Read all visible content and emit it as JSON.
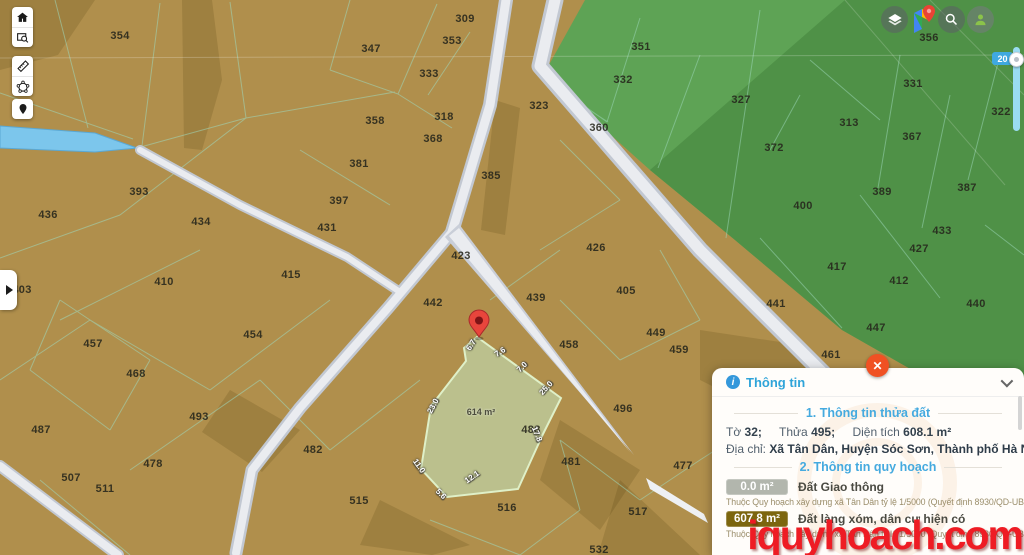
{
  "app": {
    "watermark": "iquyhoach.com"
  },
  "toolbar": {
    "buttons": [
      {
        "icon": "home-icon"
      },
      {
        "icon": "area-zoom-icon"
      },
      {
        "icon": "ruler-icon"
      },
      {
        "icon": "polygon-draw-icon"
      },
      {
        "icon": "location-pin-icon"
      }
    ]
  },
  "topbar": {
    "buttons": [
      {
        "icon": "layers-icon"
      },
      {
        "icon": "google-maps-icon"
      },
      {
        "icon": "search-icon"
      },
      {
        "icon": "user-icon"
      }
    ]
  },
  "zoom_control": {
    "level": "20"
  },
  "map": {
    "colors": {
      "land": "#b08f4c",
      "land_dark_overlay": "rgba(70,52,8,0.16)",
      "green": "#5ea355",
      "green_dark": "#4f9147",
      "road_fill": "#eaecf0",
      "road_casing": "#c2c8d2",
      "water": "#7cc6ec",
      "boundary_line": "#9fd9bd",
      "selected_fill": "#bcc492",
      "selected_stroke": "#dff0c8",
      "pin": "#e8453c"
    },
    "parcels": [
      {
        "n": "354",
        "x": 120,
        "y": 36
      },
      {
        "n": "309",
        "x": 465,
        "y": 19
      },
      {
        "n": "353",
        "x": 452,
        "y": 41
      },
      {
        "n": "347",
        "x": 371,
        "y": 49
      },
      {
        "n": "333",
        "x": 429,
        "y": 74
      },
      {
        "n": "323",
        "x": 539,
        "y": 106
      },
      {
        "n": "351",
        "x": 641,
        "y": 47
      },
      {
        "n": "332",
        "x": 623,
        "y": 80
      },
      {
        "n": "360",
        "x": 599,
        "y": 128
      },
      {
        "n": "327",
        "x": 741,
        "y": 100
      },
      {
        "n": "313",
        "x": 849,
        "y": 123
      },
      {
        "n": "331",
        "x": 913,
        "y": 84
      },
      {
        "n": "356",
        "x": 929,
        "y": 38
      },
      {
        "n": "322",
        "x": 1001,
        "y": 112
      },
      {
        "n": "372",
        "x": 774,
        "y": 148
      },
      {
        "n": "367",
        "x": 912,
        "y": 137
      },
      {
        "n": "389",
        "x": 882,
        "y": 192
      },
      {
        "n": "387",
        "x": 967,
        "y": 188
      },
      {
        "n": "400",
        "x": 803,
        "y": 206
      },
      {
        "n": "433",
        "x": 942,
        "y": 231
      },
      {
        "n": "358",
        "x": 375,
        "y": 121
      },
      {
        "n": "318",
        "x": 444,
        "y": 117
      },
      {
        "n": "368",
        "x": 433,
        "y": 139
      },
      {
        "n": "381",
        "x": 359,
        "y": 164
      },
      {
        "n": "385",
        "x": 491,
        "y": 176
      },
      {
        "n": "397",
        "x": 339,
        "y": 201
      },
      {
        "n": "393",
        "x": 139,
        "y": 192
      },
      {
        "n": "436",
        "x": 48,
        "y": 215
      },
      {
        "n": "434",
        "x": 201,
        "y": 222
      },
      {
        "n": "431",
        "x": 327,
        "y": 228
      },
      {
        "n": "423",
        "x": 461,
        "y": 256
      },
      {
        "n": "426",
        "x": 596,
        "y": 248
      },
      {
        "n": "410",
        "x": 164,
        "y": 282
      },
      {
        "n": "415",
        "x": 291,
        "y": 275
      },
      {
        "n": "403",
        "x": 22,
        "y": 290
      },
      {
        "n": "442",
        "x": 433,
        "y": 303
      },
      {
        "n": "439",
        "x": 536,
        "y": 298
      },
      {
        "n": "405",
        "x": 626,
        "y": 291
      },
      {
        "n": "427",
        "x": 919,
        "y": 249
      },
      {
        "n": "417",
        "x": 837,
        "y": 267
      },
      {
        "n": "412",
        "x": 899,
        "y": 281
      },
      {
        "n": "441",
        "x": 776,
        "y": 304
      },
      {
        "n": "440",
        "x": 976,
        "y": 304
      },
      {
        "n": "454",
        "x": 253,
        "y": 335
      },
      {
        "n": "457",
        "x": 93,
        "y": 344
      },
      {
        "n": "458",
        "x": 569,
        "y": 345
      },
      {
        "n": "449",
        "x": 656,
        "y": 333
      },
      {
        "n": "459",
        "x": 679,
        "y": 350
      },
      {
        "n": "447",
        "x": 876,
        "y": 328
      },
      {
        "n": "461",
        "x": 831,
        "y": 355
      },
      {
        "n": "468",
        "x": 136,
        "y": 374
      },
      {
        "n": "496",
        "x": 623,
        "y": 409
      },
      {
        "n": "488",
        "x": 531,
        "y": 430
      },
      {
        "n": "493",
        "x": 199,
        "y": 417
      },
      {
        "n": "487",
        "x": 41,
        "y": 430
      },
      {
        "n": "481",
        "x": 571,
        "y": 462
      },
      {
        "n": "478",
        "x": 153,
        "y": 464
      },
      {
        "n": "477",
        "x": 683,
        "y": 466
      },
      {
        "n": "507",
        "x": 71,
        "y": 478
      },
      {
        "n": "511",
        "x": 105,
        "y": 489
      },
      {
        "n": "515",
        "x": 359,
        "y": 501
      },
      {
        "n": "516",
        "x": 507,
        "y": 508
      },
      {
        "n": "517",
        "x": 638,
        "y": 512
      },
      {
        "n": "532",
        "x": 599,
        "y": 550
      },
      {
        "n": "482",
        "x": 313,
        "y": 450
      }
    ],
    "selected_parcel": {
      "area_label": "614 m²",
      "area_x": 481,
      "area_y": 412,
      "edge_labels": [
        {
          "t": "6.7",
          "x": 471,
          "y": 345,
          "r": -58
        },
        {
          "t": "7.6",
          "x": 500,
          "y": 352,
          "r": -32
        },
        {
          "t": "7.0",
          "x": 522,
          "y": 367,
          "r": -45
        },
        {
          "t": "25.0",
          "x": 546,
          "y": 388,
          "r": -48
        },
        {
          "t": "23.0",
          "x": 433,
          "y": 406,
          "r": -62
        },
        {
          "t": "17.8",
          "x": 537,
          "y": 434,
          "r": 68
        },
        {
          "t": "11.0",
          "x": 419,
          "y": 466,
          "r": 55
        },
        {
          "t": "12.1",
          "x": 472,
          "y": 477,
          "r": -35
        },
        {
          "t": "5.6",
          "x": 441,
          "y": 494,
          "r": 45
        }
      ]
    }
  },
  "panel": {
    "title": "Thông tin",
    "info_icon": "i",
    "section1": "1. Thông tin thửa đất",
    "sheet_label": "Tờ",
    "sheet_value": "32;",
    "plot_label": "Thửa",
    "plot_value": "495;",
    "area_label": "Diện tích",
    "area_value": "608.1 m²",
    "address_label": "Địa chỉ:",
    "address_value": "Xã Tân Dân, Huyện Sóc Sơn, Thành phố Hà Nội",
    "section2": "2. Thông tin quy hoạch",
    "rows": [
      {
        "badge": "0.0 m²",
        "badge_color": "#b2b6ad",
        "label": "Đất Giao thông",
        "note": "Thuộc Quy hoạch xây dựng xã Tân Dân tỷ lệ 1/5000 (Quyết định 8930/QD-UBND)"
      },
      {
        "badge": "607.8 m²",
        "badge_color": "#7c660f",
        "label": "Đất làng xóm, dân cư hiện có",
        "note": "Thuộc Quy hoạch xây dựng xã Tân Dân tỷ lệ 1/5000 (Quyết định 8930/QD-UBND)"
      }
    ]
  }
}
